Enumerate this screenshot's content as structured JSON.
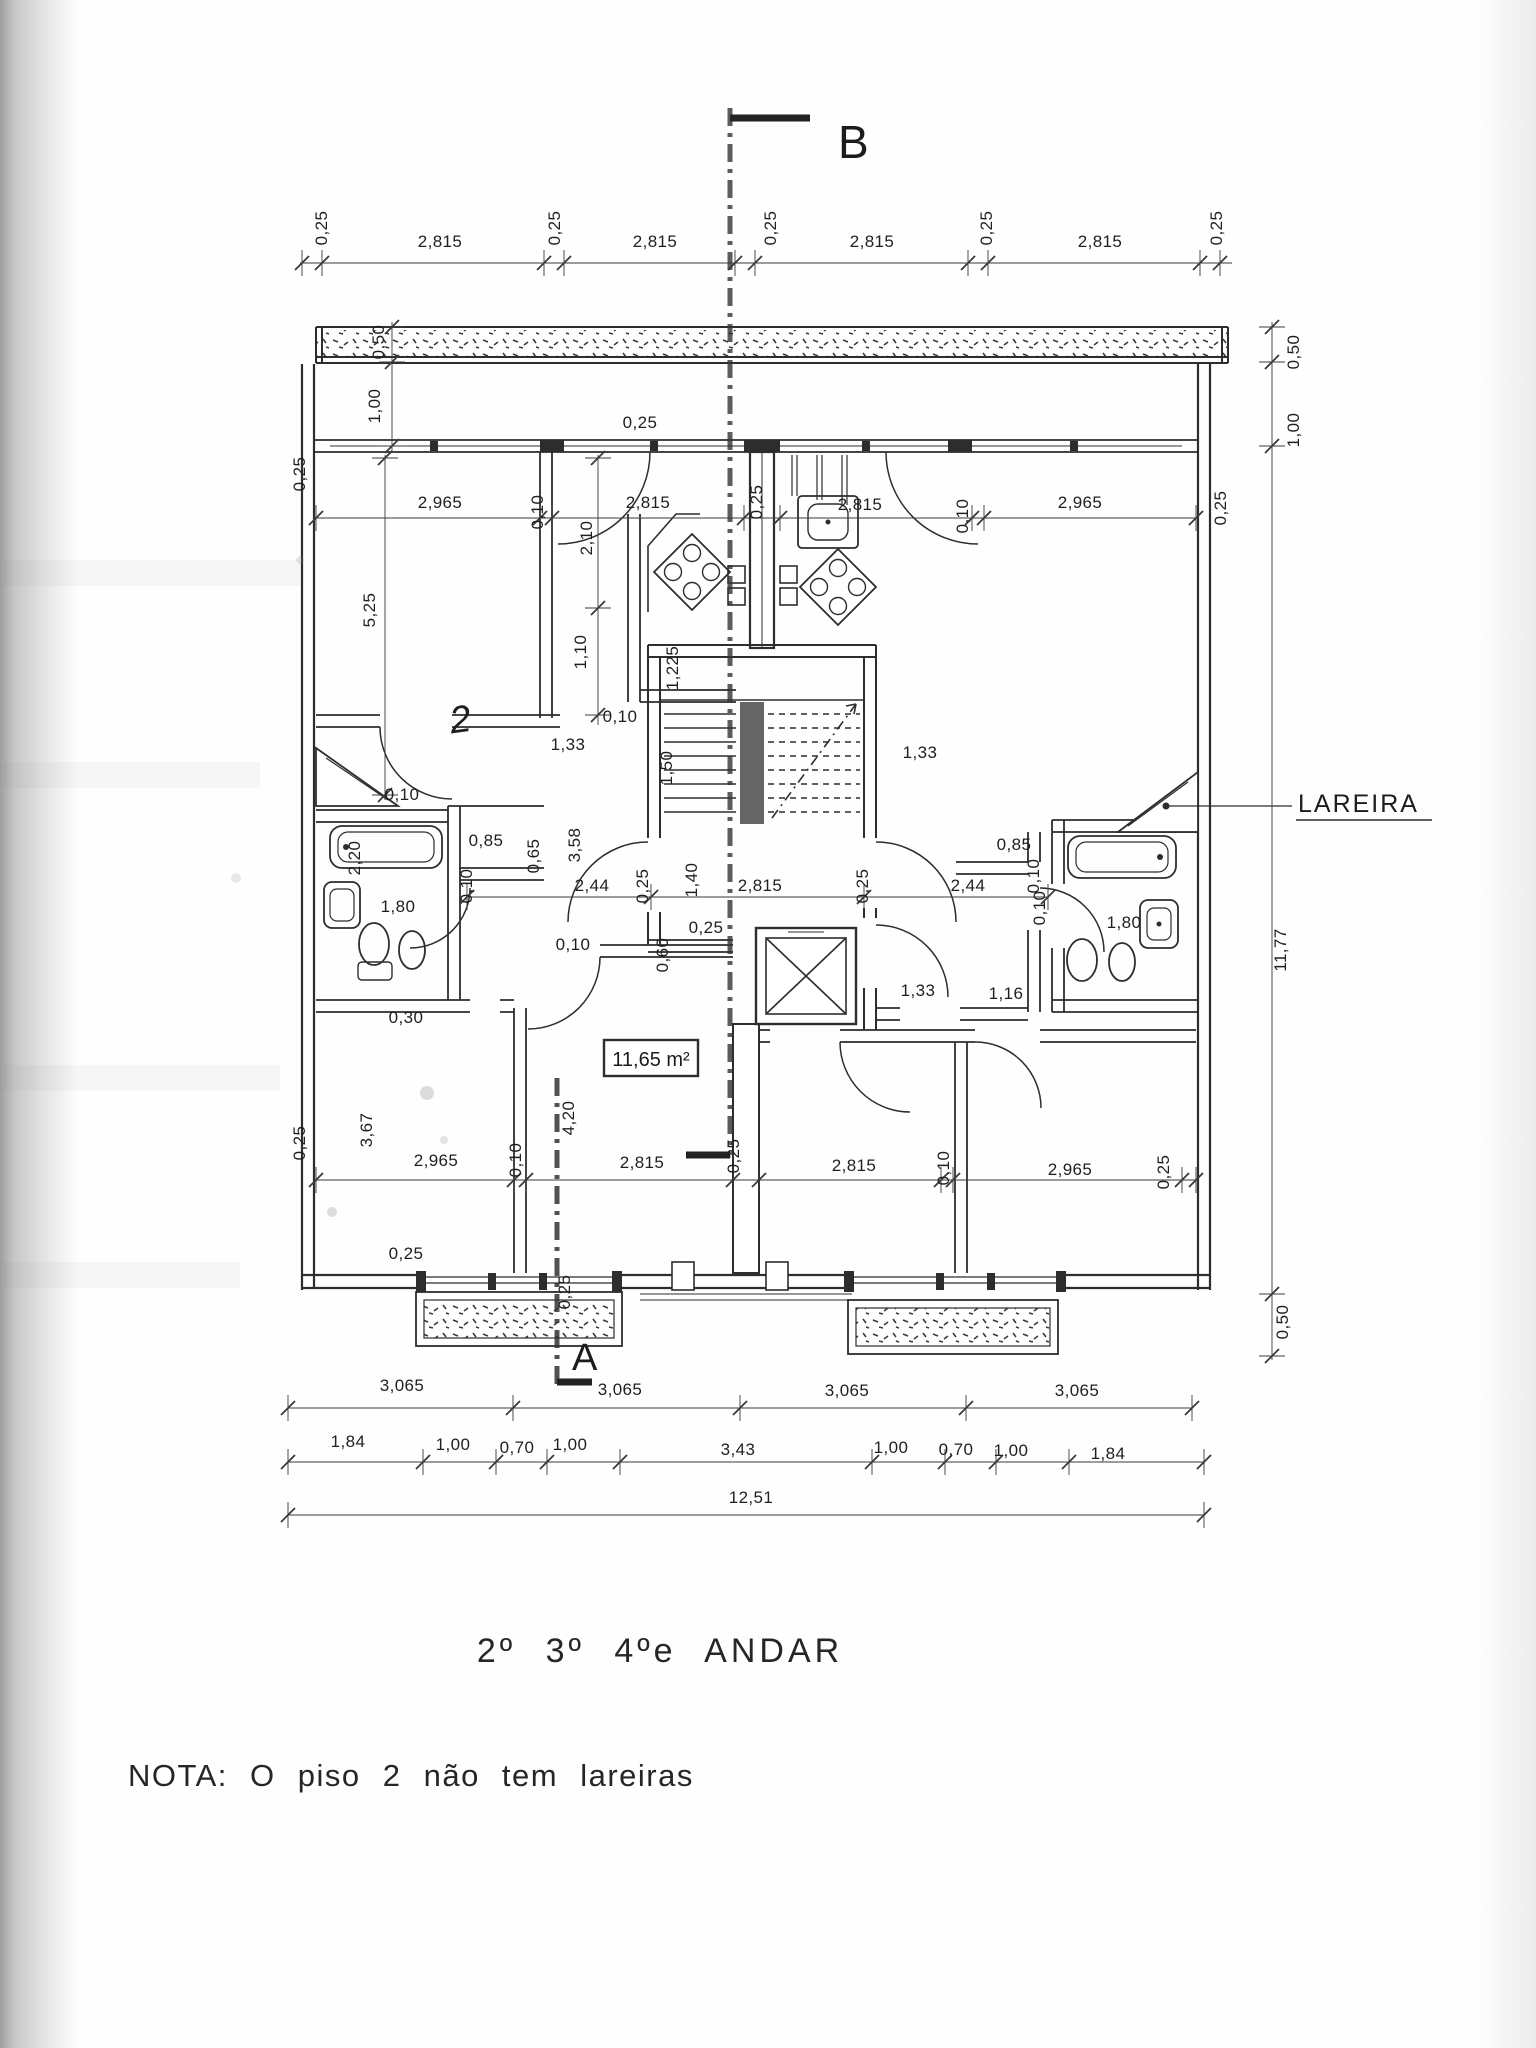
{
  "plan": {
    "title": "2º 3º 4ºe ANDAR",
    "note": "NOTA: O piso 2 não tem lareiras",
    "section_top": "B",
    "section_bottom": "A",
    "fireplace_label": "LAREIRA",
    "room_area": "11,65 m²",
    "ink_color": "#2d2d2d",
    "paper_color": "#fefefe"
  },
  "dim_labels": [
    {
      "t": "0,25",
      "x": 327,
      "y": 228,
      "r": 1
    },
    {
      "t": "2,815",
      "x": 440,
      "y": 247
    },
    {
      "t": "0,25",
      "x": 560,
      "y": 228,
      "r": 1
    },
    {
      "t": "2,815",
      "x": 655,
      "y": 247
    },
    {
      "t": "0,25",
      "x": 776,
      "y": 228,
      "r": 1
    },
    {
      "t": "2,815",
      "x": 872,
      "y": 247
    },
    {
      "t": "0,25",
      "x": 992,
      "y": 228,
      "r": 1
    },
    {
      "t": "2,815",
      "x": 1100,
      "y": 247
    },
    {
      "t": "0,25",
      "x": 1222,
      "y": 228,
      "r": 1
    },
    {
      "t": "0,50",
      "x": 384,
      "y": 342,
      "r": 1
    },
    {
      "t": "1,00",
      "x": 380,
      "y": 406,
      "r": 1
    },
    {
      "t": "0,50",
      "x": 1299,
      "y": 352,
      "r": 1
    },
    {
      "t": "1,00",
      "x": 1299,
      "y": 430,
      "r": 1
    },
    {
      "t": "0,25",
      "x": 640,
      "y": 428
    },
    {
      "t": "0,25",
      "x": 305,
      "y": 474,
      "r": 1
    },
    {
      "t": "2,965",
      "x": 440,
      "y": 508
    },
    {
      "t": "0,10",
      "x": 543,
      "y": 512,
      "r": 1
    },
    {
      "t": "2,815",
      "x": 648,
      "y": 508
    },
    {
      "t": "0,25",
      "x": 762,
      "y": 502,
      "r": 1
    },
    {
      "t": "2,815",
      "x": 860,
      "y": 510
    },
    {
      "t": "0,10",
      "x": 968,
      "y": 516,
      "r": 1
    },
    {
      "t": "2,965",
      "x": 1080,
      "y": 508
    },
    {
      "t": "0,25",
      "x": 1226,
      "y": 508,
      "r": 1
    },
    {
      "t": "5,25",
      "x": 375,
      "y": 610,
      "r": 1
    },
    {
      "t": "2,10",
      "x": 592,
      "y": 538,
      "r": 1
    },
    {
      "t": "1,10",
      "x": 586,
      "y": 652,
      "r": 1
    },
    {
      "t": "1,225",
      "x": 678,
      "y": 668,
      "r": 1
    },
    {
      "t": "0,10",
      "x": 620,
      "y": 722
    },
    {
      "t": "1,33",
      "x": 568,
      "y": 750
    },
    {
      "t": "1,33",
      "x": 920,
      "y": 758
    },
    {
      "t": "2",
      "x": 462,
      "y": 732,
      "hand": 1
    },
    {
      "t": "0,10",
      "x": 402,
      "y": 800
    },
    {
      "t": "2,20",
      "x": 360,
      "y": 858,
      "r": 1
    },
    {
      "t": "0,85",
      "x": 486,
      "y": 846
    },
    {
      "t": "0,65",
      "x": 539,
      "y": 856,
      "r": 1
    },
    {
      "t": "0,10",
      "x": 472,
      "y": 886,
      "r": 1
    },
    {
      "t": "2,44",
      "x": 592,
      "y": 891
    },
    {
      "t": "1,80",
      "x": 398,
      "y": 912
    },
    {
      "t": "0,30",
      "x": 406,
      "y": 1023
    },
    {
      "t": "1,50",
      "x": 672,
      "y": 768,
      "r": 1
    },
    {
      "t": "3,58",
      "x": 580,
      "y": 845,
      "r": 1
    },
    {
      "t": "0,25",
      "x": 648,
      "y": 886,
      "r": 1
    },
    {
      "t": "1,40",
      "x": 697,
      "y": 880,
      "r": 1
    },
    {
      "t": "2,815",
      "x": 760,
      "y": 891
    },
    {
      "t": "0,25",
      "x": 868,
      "y": 886,
      "r": 1
    },
    {
      "t": "2,44",
      "x": 968,
      "y": 891
    },
    {
      "t": "0,25",
      "x": 706,
      "y": 933
    },
    {
      "t": "0,60",
      "x": 668,
      "y": 955,
      "r": 1
    },
    {
      "t": "0,10",
      "x": 573,
      "y": 950
    },
    {
      "t": "0,85",
      "x": 1014,
      "y": 850
    },
    {
      "t": "0,10",
      "x": 1039,
      "y": 876,
      "r": 1
    },
    {
      "t": "0,10",
      "x": 1045,
      "y": 908,
      "r": 1
    },
    {
      "t": "1,80",
      "x": 1124,
      "y": 928
    },
    {
      "t": "1,33",
      "x": 918,
      "y": 996
    },
    {
      "t": "1,16",
      "x": 1006,
      "y": 999
    },
    {
      "t": "4,20",
      "x": 574,
      "y": 1118,
      "r": 1
    },
    {
      "t": "3,67",
      "x": 372,
      "y": 1130,
      "r": 1
    },
    {
      "t": "0,25",
      "x": 739,
      "y": 1156,
      "r": 1
    },
    {
      "t": "0,10",
      "x": 521,
      "y": 1160,
      "r": 1
    },
    {
      "t": "2,965",
      "x": 436,
      "y": 1166
    },
    {
      "t": "2,815",
      "x": 642,
      "y": 1168
    },
    {
      "t": "2,815",
      "x": 854,
      "y": 1171
    },
    {
      "t": "0,10",
      "x": 949,
      "y": 1168,
      "r": 1
    },
    {
      "t": "2,965",
      "x": 1070,
      "y": 1175
    },
    {
      "t": "0,25",
      "x": 1169,
      "y": 1172,
      "r": 1
    },
    {
      "t": "0,25",
      "x": 305,
      "y": 1143,
      "r": 1
    },
    {
      "t": "0,25",
      "x": 406,
      "y": 1259
    },
    {
      "t": "0,25",
      "x": 570,
      "y": 1292,
      "r": 1
    },
    {
      "t": "11,77",
      "x": 1286,
      "y": 950,
      "r": 1
    },
    {
      "t": "0,50",
      "x": 1288,
      "y": 1322,
      "r": 1
    },
    {
      "t": "3,065",
      "x": 402,
      "y": 1391
    },
    {
      "t": "3,065",
      "x": 620,
      "y": 1395
    },
    {
      "t": "3,065",
      "x": 847,
      "y": 1396
    },
    {
      "t": "3,065",
      "x": 1077,
      "y": 1396
    },
    {
      "t": "1,84",
      "x": 348,
      "y": 1447
    },
    {
      "t": "1,00",
      "x": 453,
      "y": 1450
    },
    {
      "t": "0,70",
      "x": 517,
      "y": 1453
    },
    {
      "t": "1,00",
      "x": 570,
      "y": 1450
    },
    {
      "t": "3,43",
      "x": 738,
      "y": 1455
    },
    {
      "t": "1,00",
      "x": 891,
      "y": 1453
    },
    {
      "t": "0,70",
      "x": 956,
      "y": 1455
    },
    {
      "t": "1,00",
      "x": 1011,
      "y": 1456
    },
    {
      "t": "1,84",
      "x": 1108,
      "y": 1459
    },
    {
      "t": "12,51",
      "x": 751,
      "y": 1503
    }
  ]
}
